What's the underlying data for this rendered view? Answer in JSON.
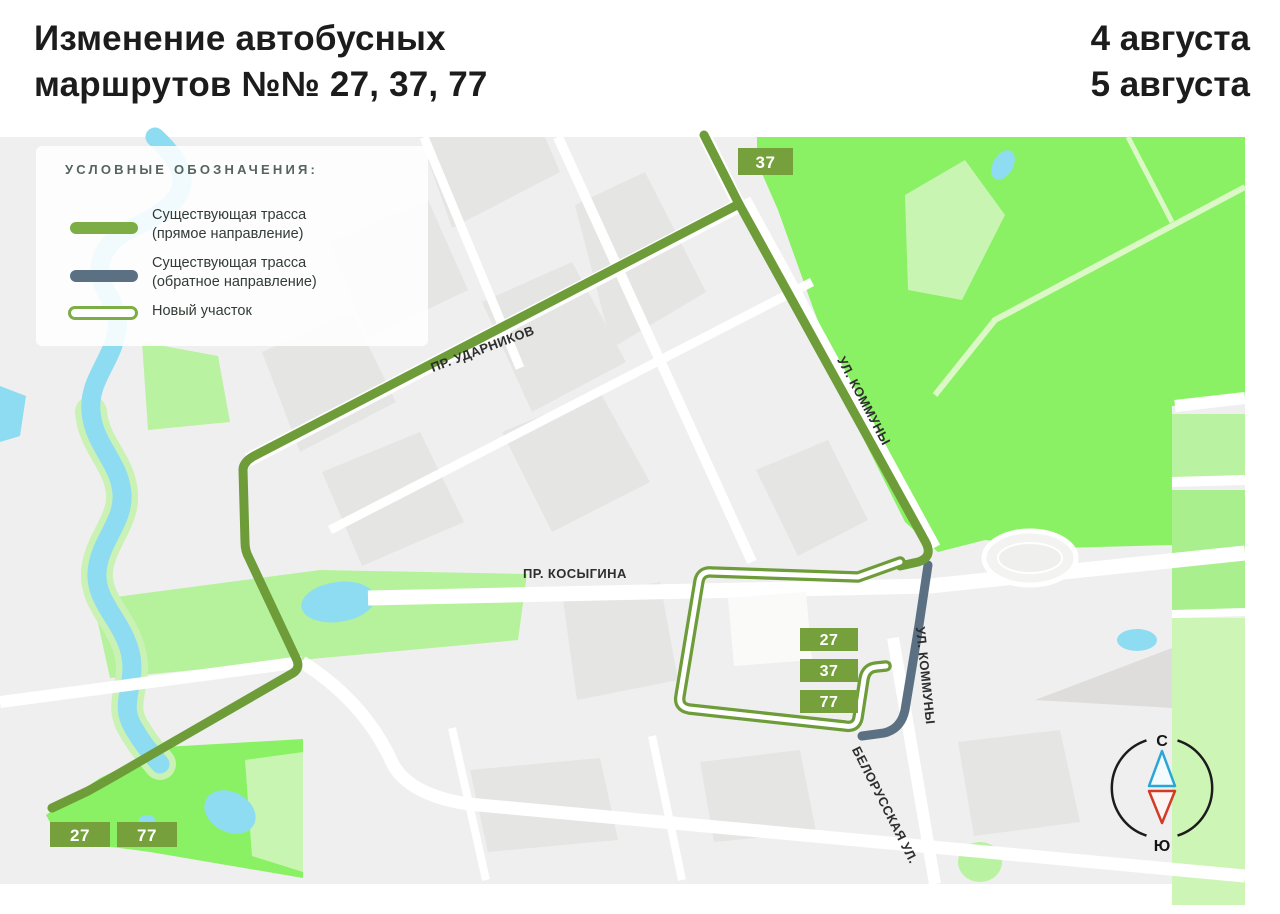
{
  "header": {
    "title_line1": "Изменение автобусных",
    "title_line2": "маршрутов №№ 27, 37, 77",
    "date_line1": "4 августа",
    "date_line2": "5 августа"
  },
  "legend": {
    "title": "УСЛОВНЫЕ ОБОЗНАЧЕНИЯ:",
    "items": [
      {
        "label_line1": "Существующая трасса",
        "label_line2": "(прямое направление)"
      },
      {
        "label_line1": "Существующая трасса",
        "label_line2": "(обратное направление)"
      },
      {
        "label_line1": "Новый участок",
        "label_line2": ""
      }
    ]
  },
  "map": {
    "street_labels": {
      "udarnikov": "ПР. УДАРНИКОВ",
      "kommuny_upper": "УЛ. КОММУНЫ",
      "kosygina": "ПР. КОСЫГИНА",
      "kommuny_lower": "УЛ. КОММУНЫ",
      "belorusskaya": "БЕЛОРУССКАЯ УЛ."
    },
    "badges": {
      "top": "37",
      "stack": [
        "27",
        "37",
        "77"
      ],
      "bottom": [
        "27",
        "77"
      ]
    },
    "compass": {
      "north": "С",
      "south": "Ю"
    }
  },
  "colors": {
    "route_forward_green": "#6d9c39",
    "route_reverse_gray": "#5b7183",
    "new_section_outline": "#6d9c39",
    "badge_green": "#75a03c",
    "park_bright_green": "#8af064",
    "park_light_green": "#c9f5b3",
    "water_blue": "#8edcf1",
    "map_background": "#efefef",
    "compass_north_blue": "#29a5d8",
    "compass_south_red": "#d23b28"
  }
}
